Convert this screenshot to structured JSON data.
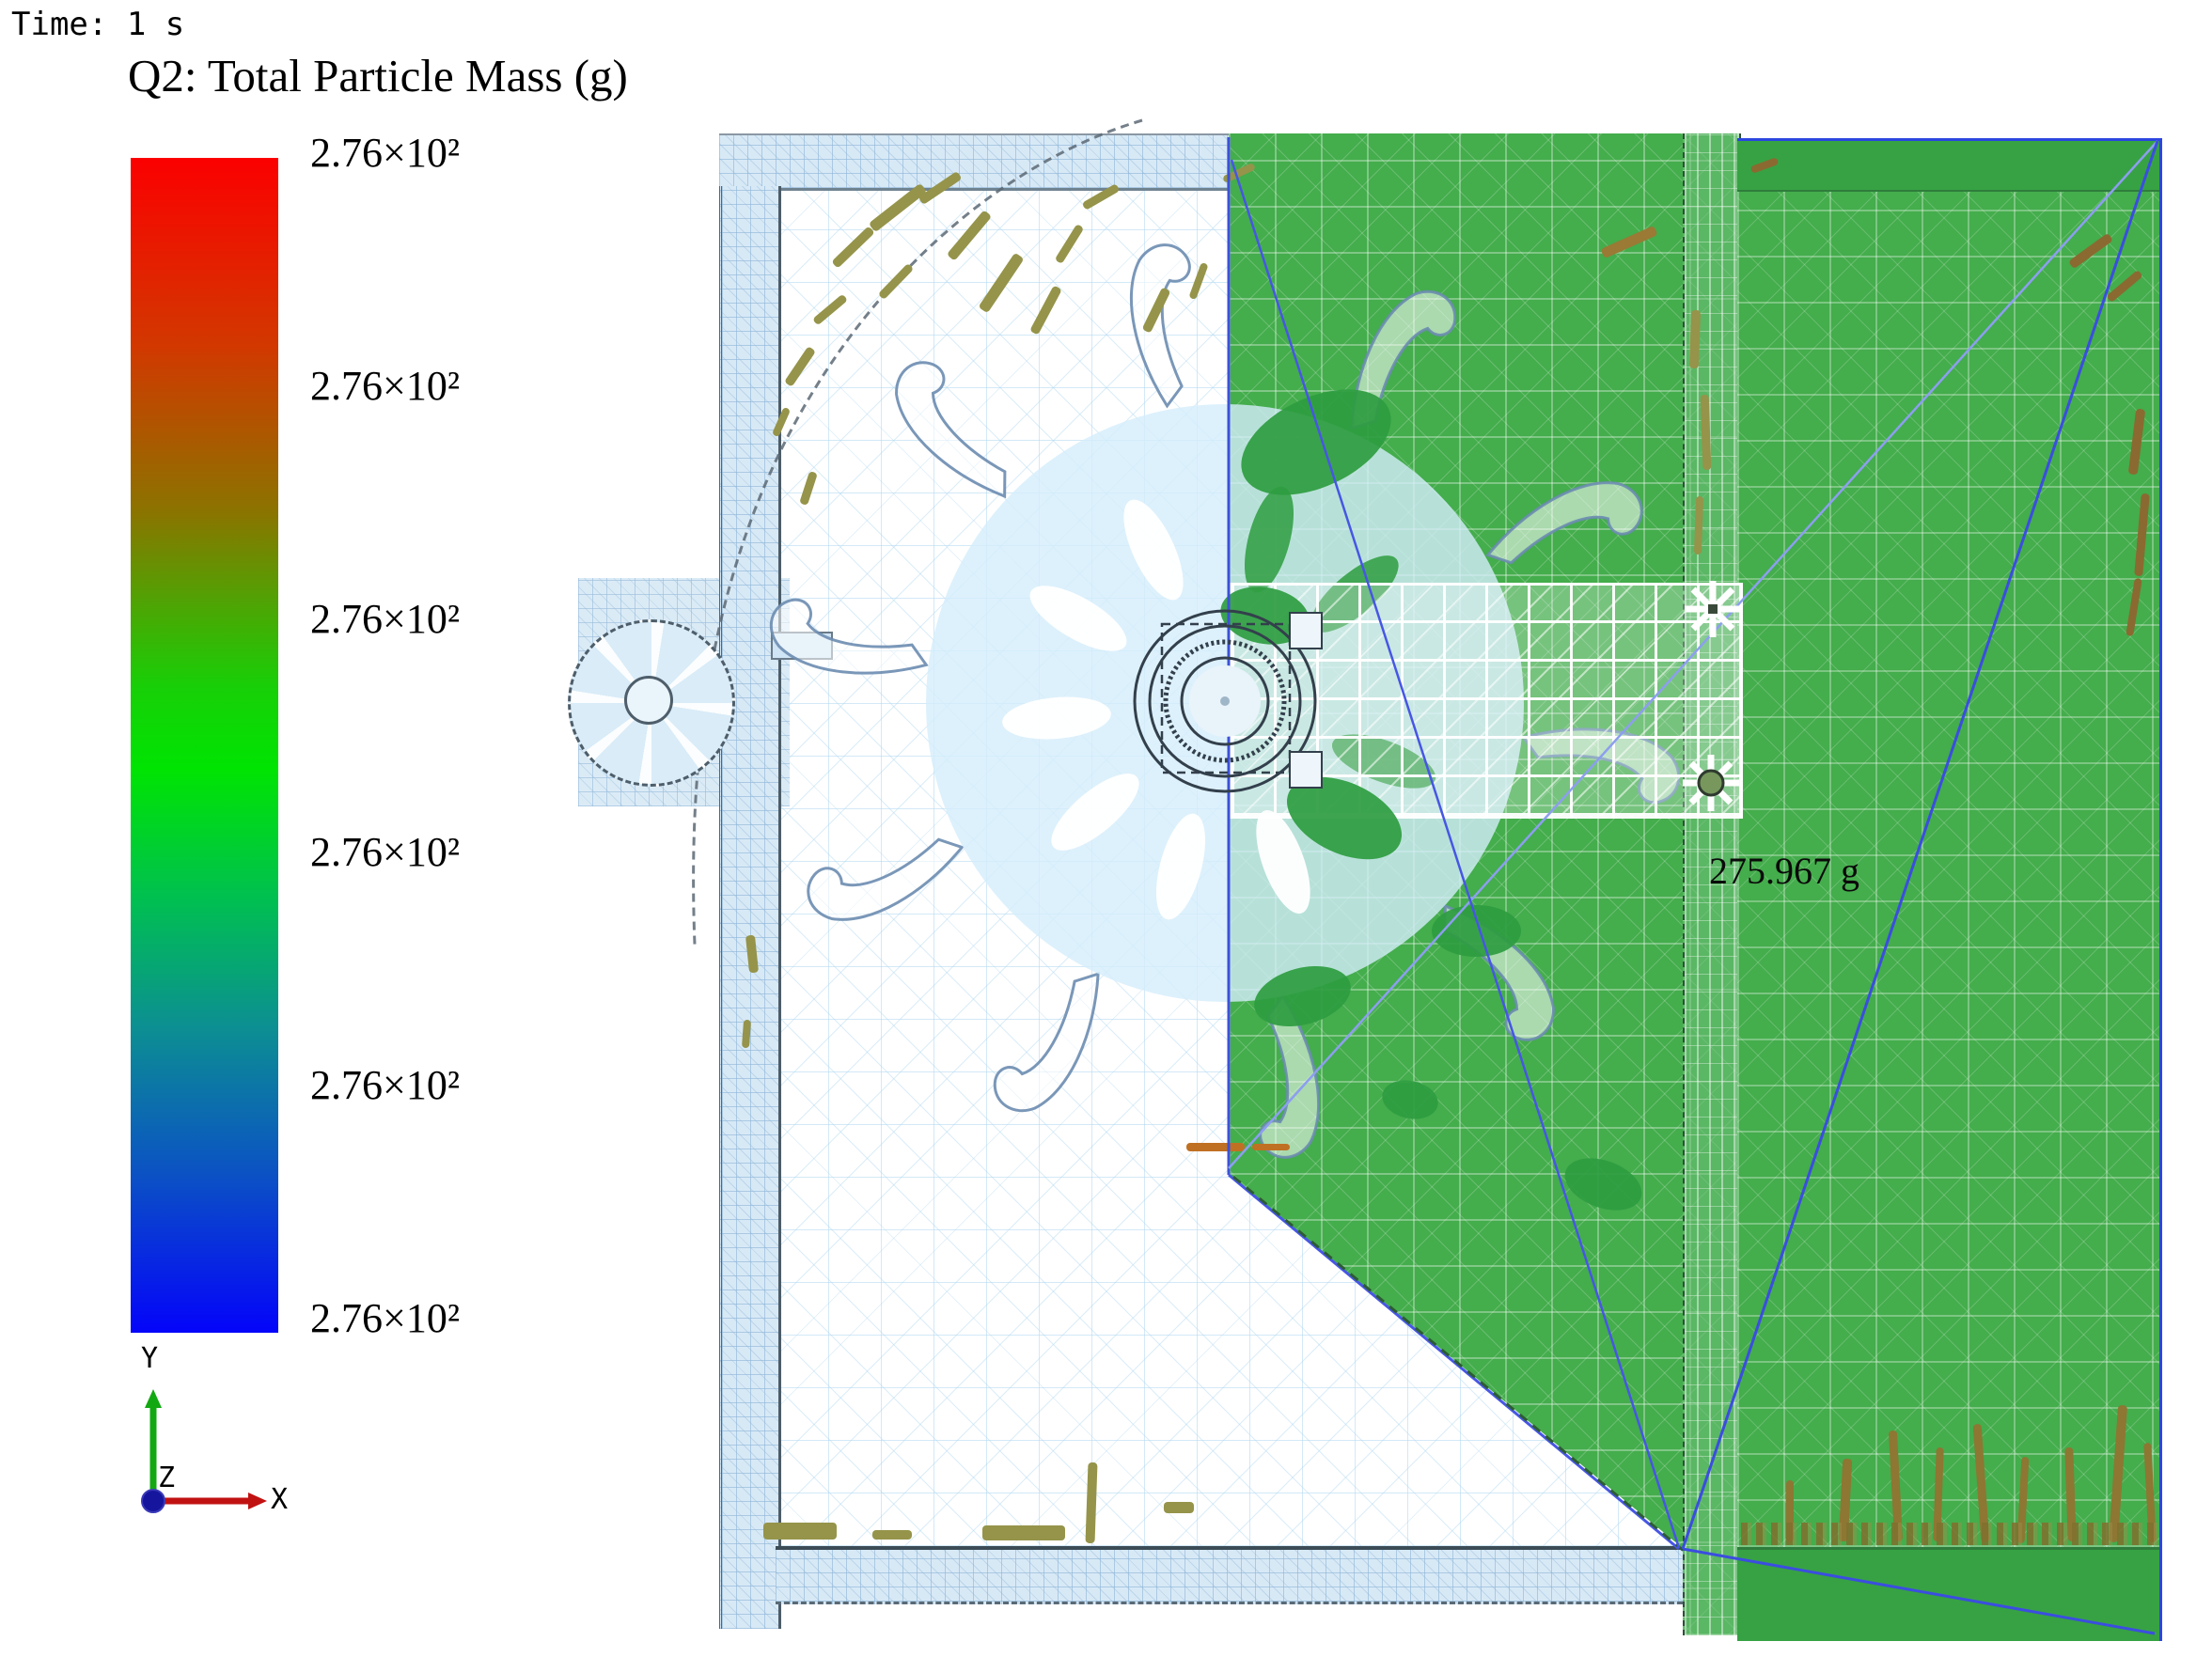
{
  "hud": {
    "time_label": "Time: 1 s",
    "title": "Q2: Total Particle Mass (g)",
    "annotation": "275.967 g"
  },
  "legend": {
    "labels": [
      "2.76×10²",
      "2.76×10²",
      "2.76×10²",
      "2.76×10²",
      "2.76×10²",
      "2.76×10²"
    ],
    "gradient_stops": [
      "#fb0000 0%",
      "#d23800 16%",
      "#8c7300 30%",
      "#18cf07 45%",
      "#00e402 52%",
      "#00c050 63%",
      "#0c8f92 74%",
      "#0b4fc6 87%",
      "#0404fa 100%"
    ]
  },
  "triad": {
    "x": "X",
    "y": "Y",
    "z": "Z",
    "x_color": "#c11212",
    "y_color": "#12a812",
    "z_color": "#15159d"
  },
  "scene": {
    "colors": {
      "green": "#44ad4c",
      "green_band": "#37a244",
      "green_dark": "#2e9c40",
      "mesh_blue": "#d8e9f6",
      "disc_blue": "rgba(213,237,251,0.8)",
      "edge_blue": "#3b4de0",
      "edge_blue_light": "#8d9ef0",
      "olive": "#95944a",
      "brown": "#8d7733",
      "orange": "#c07023"
    },
    "blade_path": "M 320 -6 C 378 -30 444 -34 478 -8 C 496 9 492 34 472 42 C 456 48 444 34 451 20 C 434 3 390 -1 338 13 Z",
    "blades": {
      "count": 10,
      "step_deg": 36,
      "offset_deg": 8
    },
    "marks": [
      [
        920,
        215,
        70,
        12,
        -38
      ],
      [
        880,
        258,
        55,
        10,
        -44
      ],
      [
        975,
        195,
        50,
        10,
        -34
      ],
      [
        1000,
        245,
        62,
        11,
        -50
      ],
      [
        930,
        295,
        46,
        9,
        -46
      ],
      [
        1030,
        295,
        70,
        12,
        -56
      ],
      [
        1085,
        325,
        55,
        10,
        -62
      ],
      [
        1115,
        255,
        45,
        9,
        -58
      ],
      [
        862,
        325,
        42,
        9,
        -40
      ],
      [
        828,
        385,
        46,
        10,
        -56
      ],
      [
        815,
        445,
        32,
        8,
        -66
      ],
      [
        842,
        515,
        36,
        9,
        -72
      ],
      [
        1150,
        205,
        42,
        9,
        -30
      ],
      [
        1205,
        325,
        50,
        10,
        -64
      ],
      [
        1255,
        295,
        40,
        8,
        -70
      ],
      [
        1300,
        180,
        36,
        8,
        -25
      ],
      [
        795,
        995,
        10,
        40,
        -6
      ],
      [
        790,
        1085,
        8,
        30,
        4
      ],
      [
        812,
        1620,
        78,
        18,
        0
      ],
      [
        1045,
        1623,
        88,
        16,
        0
      ],
      [
        928,
        1628,
        42,
        10,
        0
      ],
      [
        1156,
        1556,
        10,
        86,
        2
      ],
      [
        1238,
        1598,
        32,
        12,
        0
      ],
      [
        1262,
        1216,
        62,
        9,
        0,
        "#c07023"
      ],
      [
        1332,
        1217,
        40,
        7,
        0,
        "#c07023"
      ],
      [
        1798,
        330,
        10,
        62,
        2
      ],
      [
        1810,
        420,
        9,
        80,
        -2
      ],
      [
        1803,
        528,
        8,
        62,
        2
      ],
      [
        1702,
        252,
        62,
        11,
        -24,
        "#9a7a35"
      ],
      [
        1900,
        1575,
        8,
        66,
        0,
        "#8d7733"
      ],
      [
        1958,
        1552,
        10,
        88,
        3,
        "#8d7733"
      ],
      [
        2012,
        1522,
        9,
        118,
        -3,
        "#8d7733"
      ],
      [
        2058,
        1540,
        8,
        100,
        2,
        "#8d7733"
      ],
      [
        2103,
        1515,
        9,
        126,
        -4,
        "#8d7733"
      ],
      [
        2148,
        1550,
        8,
        92,
        3,
        "#8d7733"
      ],
      [
        2198,
        1540,
        9,
        100,
        -2,
        "#8d7733"
      ],
      [
        2248,
        1495,
        10,
        146,
        4,
        "#8d7733"
      ],
      [
        2283,
        1535,
        8,
        106,
        -3,
        "#8d7733"
      ],
      [
        2268,
        435,
        10,
        70,
        7,
        "#8a6a30"
      ],
      [
        2274,
        525,
        9,
        88,
        5,
        "#8a6a30"
      ],
      [
        2266,
        615,
        8,
        62,
        9,
        "#8a6a30"
      ],
      [
        2198,
        262,
        52,
        10,
        -36,
        "#8a6a30"
      ],
      [
        2238,
        300,
        44,
        9,
        -40,
        "#8a6a30"
      ],
      [
        1862,
        172,
        30,
        8,
        -20,
        "#8a6a30"
      ]
    ],
    "blobs": [
      [
        1400,
        470,
        170,
        95,
        -25
      ],
      [
        1345,
        655,
        95,
        60,
        10
      ],
      [
        1430,
        870,
        130,
        75,
        25
      ],
      [
        1385,
        1060,
        105,
        60,
        -15
      ],
      [
        1570,
        990,
        95,
        55,
        0
      ],
      [
        1705,
        1260,
        85,
        50,
        20
      ],
      [
        1500,
        1170,
        60,
        40,
        12
      ]
    ],
    "petals": {
      "white": [
        [
          1227,
          585,
          -115
        ],
        [
          1147,
          658,
          -150
        ],
        [
          1124,
          764,
          -185
        ],
        [
          1165,
          864,
          -220
        ],
        [
          1256,
          922,
          -255
        ],
        [
          1365,
          917,
          -290
        ]
      ],
      "green": [
        [
          1441,
          632,
          -40
        ],
        [
          1350,
          574,
          -75
        ],
        [
          1472,
          810,
          20
        ]
      ]
    }
  }
}
